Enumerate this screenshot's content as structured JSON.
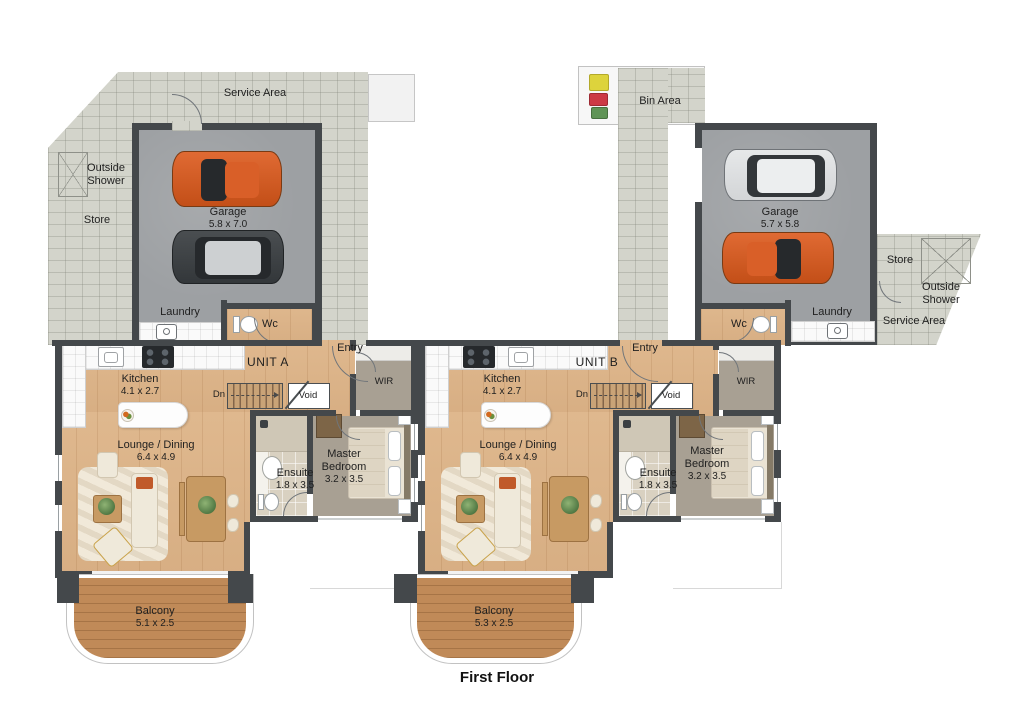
{
  "floor_label": "First Floor",
  "units": {
    "a": {
      "id": "UNIT A",
      "entry": "Entry",
      "dn": "Dn",
      "void": "Void",
      "wir": "WIR",
      "wc": "Wc",
      "laundry": "Laundry",
      "service_area": "Service Area",
      "outside_shower": "Outside Shower",
      "store": "Store",
      "garage": {
        "name": "Garage",
        "dims": "5.8 x 7.0"
      },
      "kitchen": {
        "name": "Kitchen",
        "dims": "4.1 x 2.7"
      },
      "lounge": {
        "name": "Lounge / Dining",
        "dims": "6.4 x 4.9"
      },
      "ensuite": {
        "name": "Ensuite",
        "dims": "1.8 x 3.5"
      },
      "master": {
        "name": "Master Bedroom",
        "dims": "3.2 x 3.5"
      },
      "balcony": {
        "name": "Balcony",
        "dims": "5.1 x 2.5"
      }
    },
    "b": {
      "id": "UNIT B",
      "entry": "Entry",
      "dn": "Dn",
      "void": "Void",
      "wir": "WIR",
      "wc": "Wc",
      "laundry": "Laundry",
      "service_area": "Service Area",
      "outside_shower": "Outside Shower",
      "store": "Store",
      "bin_area": "Bin Area",
      "garage": {
        "name": "Garage",
        "dims": "5.7 x 5.8"
      },
      "kitchen": {
        "name": "Kitchen",
        "dims": "4.1 x 2.7"
      },
      "lounge": {
        "name": "Lounge / Dining",
        "dims": "6.4 x 4.9"
      },
      "ensuite": {
        "name": "Ensuite",
        "dims": "1.8 x 3.5"
      },
      "master": {
        "name": "Master Bedroom",
        "dims": "3.2 x 3.5"
      },
      "balcony": {
        "name": "Balcony",
        "dims": "5.3 x 2.5"
      }
    }
  },
  "colors": {
    "wall": "#44484b",
    "paving": "#d3d4cb",
    "concrete": "#9da0a3",
    "wood_floor": "#dfb88e",
    "carpet": "#a8a093",
    "deck": "#c08a58",
    "car_orange": "#d0551e",
    "car_silver": "#dfe1e2",
    "car_dark": "#3a3e41",
    "bin_yellow": "#ddd33c",
    "bin_red": "#cc3a45",
    "bin_green": "#5f9456"
  }
}
